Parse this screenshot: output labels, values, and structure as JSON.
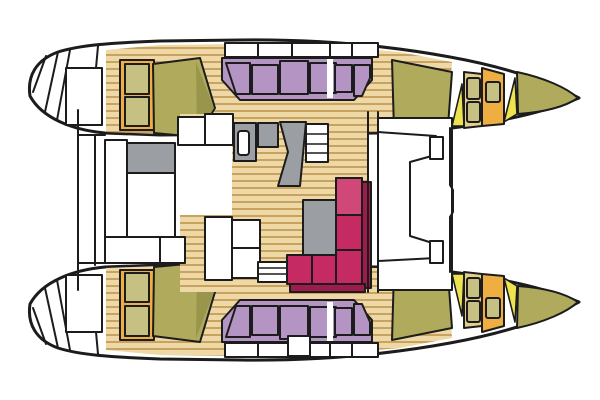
{
  "figure": {
    "kind": "catamaran-interior-floor-plan",
    "orientation": "bows-right-sterns-left"
  },
  "colors": {
    "outline": "#1c1c1c",
    "white": "#ffffff",
    "wood_base": "#eed9a6",
    "wood_line": "#c8a261",
    "olive": "#b0aa5c",
    "olive_dark": "#9a954c",
    "olive_light": "#c6c182",
    "pale_gold": "#e4cf8e",
    "gold": "#efae42",
    "yellow": "#ece34f",
    "purple": "#b394c2",
    "crimson": "#c52a63",
    "crimson_light": "#d04878",
    "crimson_dark": "#9c1d4b",
    "gray": "#9b9ea2"
  }
}
